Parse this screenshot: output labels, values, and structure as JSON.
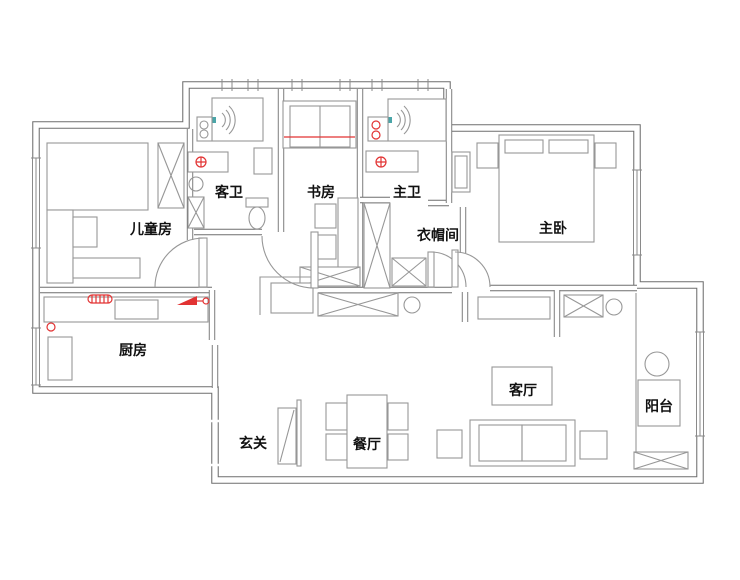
{
  "floorplan": {
    "title": "apartment-floor-plan",
    "rooms": [
      {
        "id": "children_room",
        "label": "儿童房"
      },
      {
        "id": "guest_bath",
        "label": "客卫"
      },
      {
        "id": "study",
        "label": "书房"
      },
      {
        "id": "master_bath",
        "label": "主卫"
      },
      {
        "id": "closet",
        "label": "衣帽间"
      },
      {
        "id": "master_bedroom",
        "label": "主卧"
      },
      {
        "id": "kitchen",
        "label": "厨房"
      },
      {
        "id": "entry",
        "label": "玄关"
      },
      {
        "id": "dining",
        "label": "餐厅"
      },
      {
        "id": "living",
        "label": "客厅"
      },
      {
        "id": "balcony",
        "label": "阳台"
      }
    ],
    "colors": {
      "wall": "#6e6e6e",
      "furniture_line": "#979797",
      "accent_red": "#e23333",
      "accent_teal": "#4aa5a8",
      "text": "#111111",
      "background": "#ffffff"
    },
    "symbols": {
      "wardrobe": "x-cross-box",
      "shower": "spray-fan-arcs",
      "floor_drain": "crossed-circle",
      "stove": "red-wedge-valve",
      "radiator": "red-hatched-coil",
      "window": "triple-parallel-lines",
      "door": "quarter-arc-swing"
    }
  }
}
